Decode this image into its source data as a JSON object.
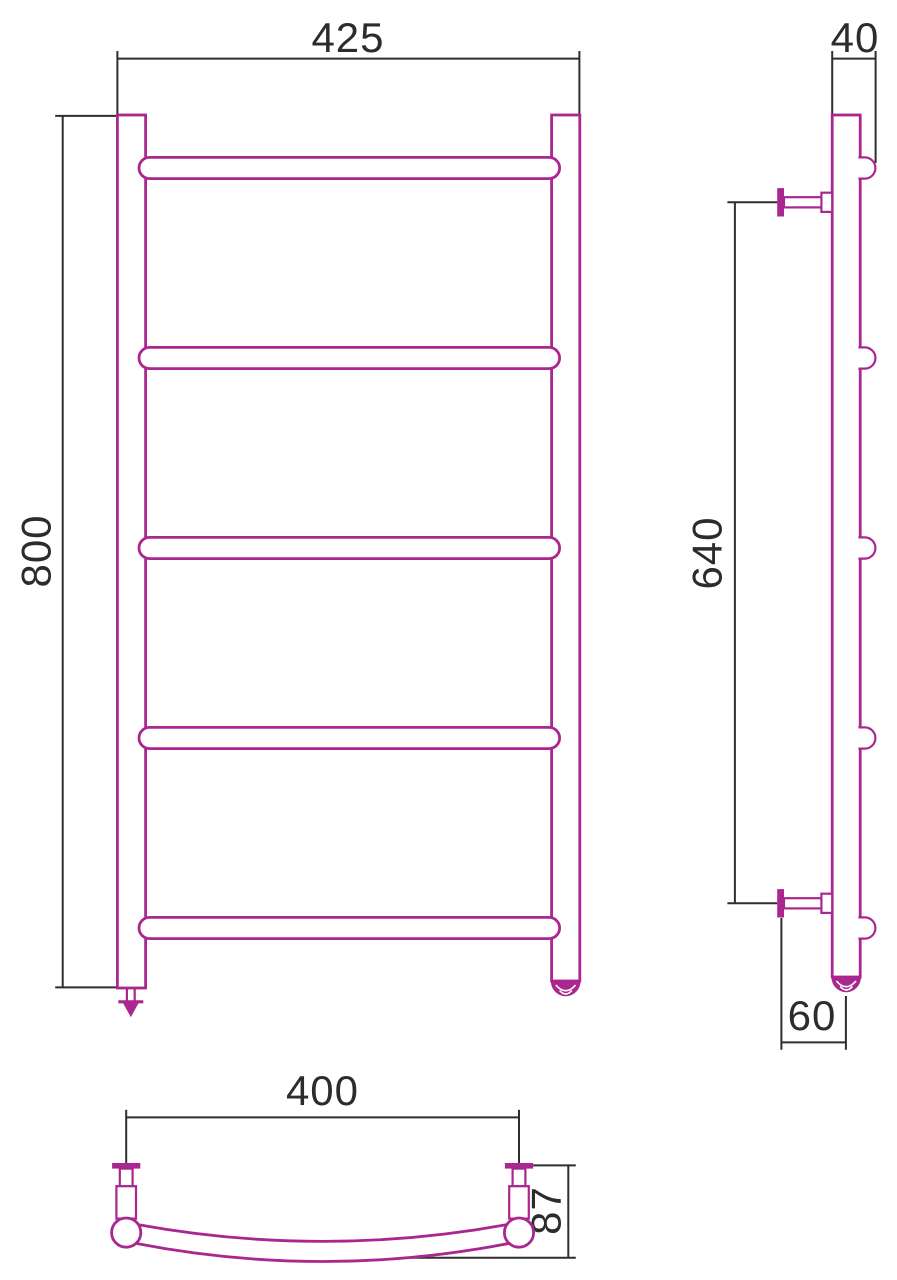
{
  "drawing": {
    "title": "Ladder towel rail — dimensioned three-view technical drawing",
    "background_color": "#ffffff",
    "part_outline_color": "#a9278f",
    "dimension_line_color": "#2e2e2e",
    "front_view": {
      "width_mm": "425",
      "height_mm": "800",
      "rung_count": 5
    },
    "side_view": {
      "depth_mm": "40",
      "bracket_spacing_mm": "640",
      "wall_offset_mm": "60",
      "rung_stub_count": 5,
      "wall_bracket_count": 2
    },
    "top_view": {
      "bracket_span_mm": "400",
      "arc_depth_mm": "87"
    }
  }
}
